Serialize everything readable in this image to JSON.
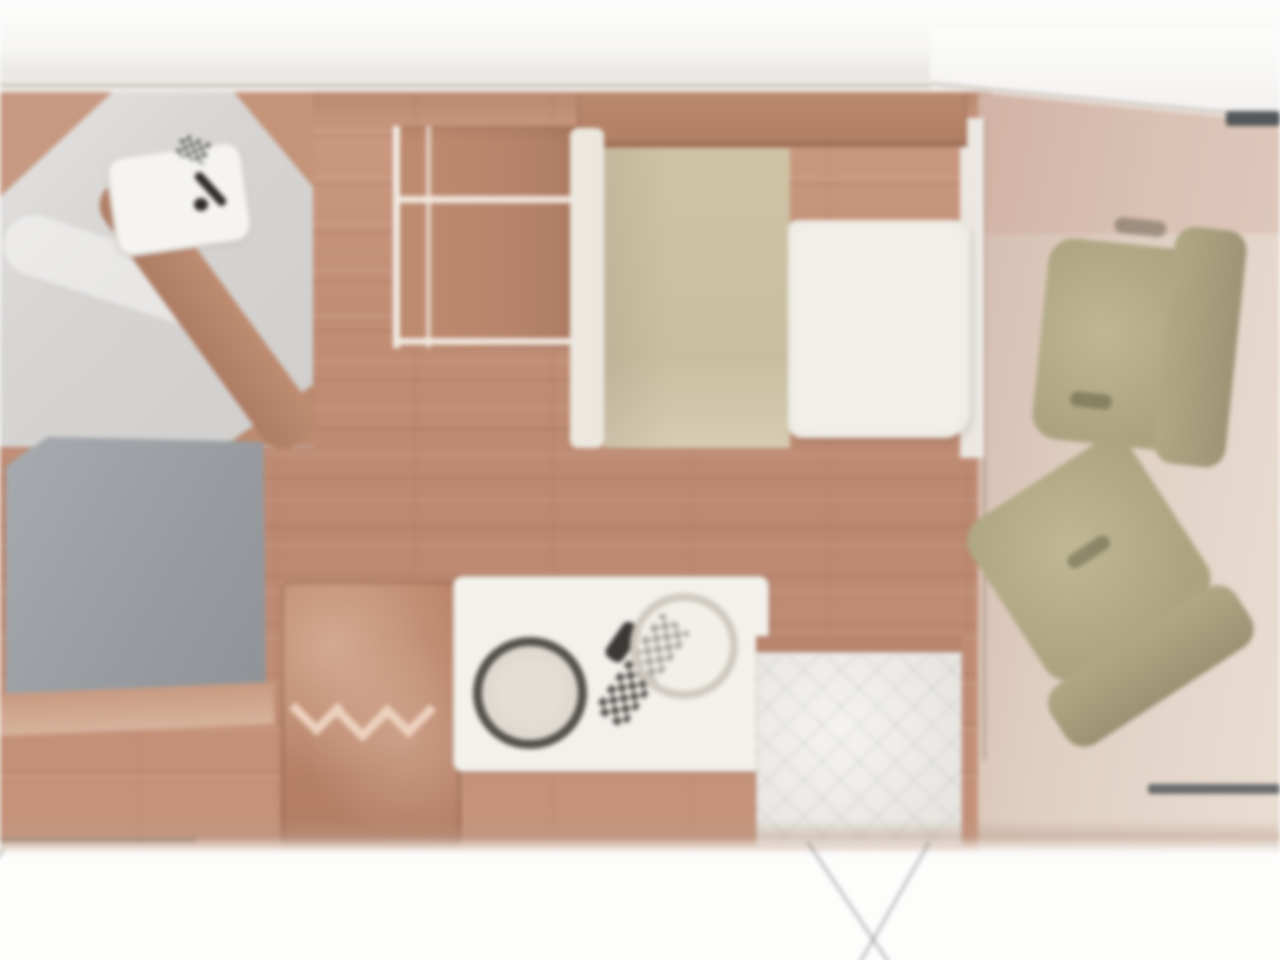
{
  "page": {
    "type": "floor-plan-image",
    "subject": "motorhome interior floor plan, top-down view, front cab on the right",
    "visible_text": "none",
    "style": "blurry low-resolution photographic render on white background"
  },
  "palette": {
    "background_white": "#fdfdfc",
    "top_wall_band": "#f1eeea",
    "wood_floor": "#c28d74",
    "wood_furniture": "#b5826a",
    "headboard_wood": "#b27e62",
    "washroom_floor_gray": "#d7d5d3",
    "shower_tray_white": "#f5f4f1",
    "rear_bed_gray": "#999da2",
    "bed_base_beige": "#cfc3a5",
    "duvet_white": "#f2f0e9",
    "kitchen_counter_white": "#f3f1ec",
    "sink_ring_dark": "#54504b",
    "cab_seat_khaki": "#b2aa85",
    "cab_seat_khaki_dark": "#9c9474",
    "cab_floor_pink": "#e0d0c4",
    "entrance_floor_light": "#eae8e4",
    "windshield_dash_dark": "#454a4e"
  },
  "icons": [
    "faucet-icon",
    "hob-burner-icon",
    "sink-icon",
    "drainer-hatch-icon",
    "door-swing-line-icon",
    "windshield-dash-icon"
  ],
  "regions": [
    {
      "id": "rear-washroom",
      "contents": "gray floor, white shower tray, dark faucet glyph, checker tile chip, diagonal wood partition"
    },
    {
      "id": "rear-gray-bed",
      "contents": "large gray mattress block with wood trim below"
    },
    {
      "id": "wardrobe-shelves",
      "contents": "wood cabinet with two white shelf lines"
    },
    {
      "id": "transverse-bed",
      "contents": "wood headboard, white side rail, beige bed base, white duvet"
    },
    {
      "id": "kitchen",
      "contents": "wood hob unit with three chevron burners, white counter with round sink, faucet, hatched drainer, faint second ring"
    },
    {
      "id": "entrance",
      "contents": "light hatched entry floor, wood ledge, open-door swing lines below wall"
    },
    {
      "id": "cab",
      "contents": "pinkish cab floor, sloped windshield wall, dark dash, two khaki swivel seats"
    }
  ]
}
